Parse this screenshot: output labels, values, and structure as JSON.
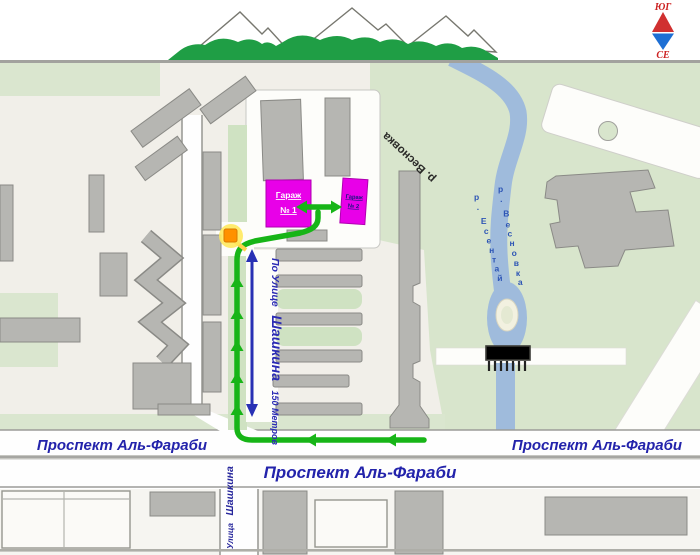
{
  "compass": {
    "south_label": "ЮГ",
    "north_label": "СЕ"
  },
  "rivers": {
    "main_label": "р. Весновка",
    "vesnovka_small": "р. Весновка",
    "esentai_small": "р. Есентай"
  },
  "garages": {
    "garage1_line1": "Гараж",
    "garage1_line2": "№ 1",
    "garage2_line1": "Гараж",
    "garage2_line2": "№ 2"
  },
  "streets": {
    "avenue_left": "Проспект Аль-Фараби",
    "avenue_center": "Проспект Аль-Фараби",
    "avenue_right": "Проспект Аль-Фараби",
    "shashkina_prefix": "По Улице",
    "shashkina_name": "Шашкина",
    "shashkina_distance": "150 Метров",
    "shashkina_bottom_prefix": "Улица",
    "shashkina_bottom_name": "Шашкина"
  },
  "colors": {
    "route_green": "#17b517",
    "river_blue": "#9fbbdc",
    "garage_magenta": "#e800e8",
    "label_blue": "#2323ab",
    "compass_red": "#cc2222",
    "compass_blue": "#1e6fd4",
    "mountain_green": "#1f9e45",
    "map_beige": "#f1efe9",
    "map_green": "#d8e5cc"
  }
}
